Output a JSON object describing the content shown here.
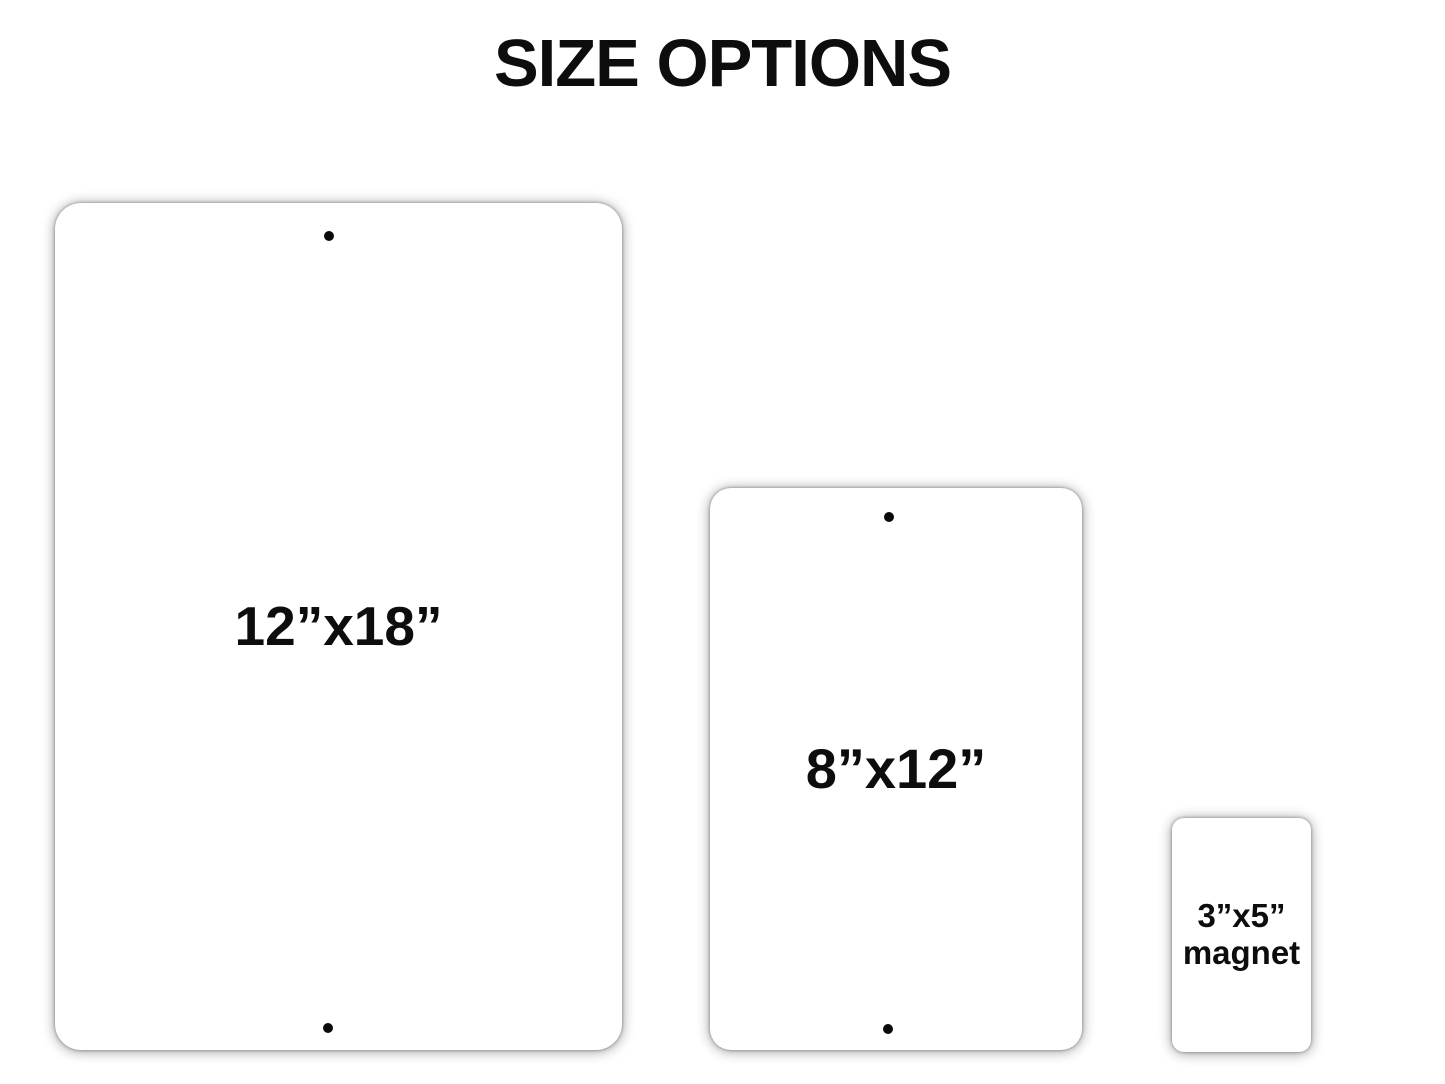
{
  "page": {
    "title": "SIZE OPTIONS"
  },
  "signs": [
    {
      "name": "large-sign",
      "label": "12”x18”",
      "type": "sign",
      "mounting_holes": 2
    },
    {
      "name": "medium-sign",
      "label": "8”x12”",
      "type": "sign",
      "mounting_holes": 2
    },
    {
      "name": "magnet",
      "label_line1": "3”x5”",
      "label_line2": "magnet",
      "type": "magnet",
      "mounting_holes": 0
    }
  ],
  "colors": {
    "background": "#ffffff",
    "item_fill": "#ffffff",
    "label_text": "#000000",
    "hole": "#000000",
    "shadow": "#999999"
  }
}
